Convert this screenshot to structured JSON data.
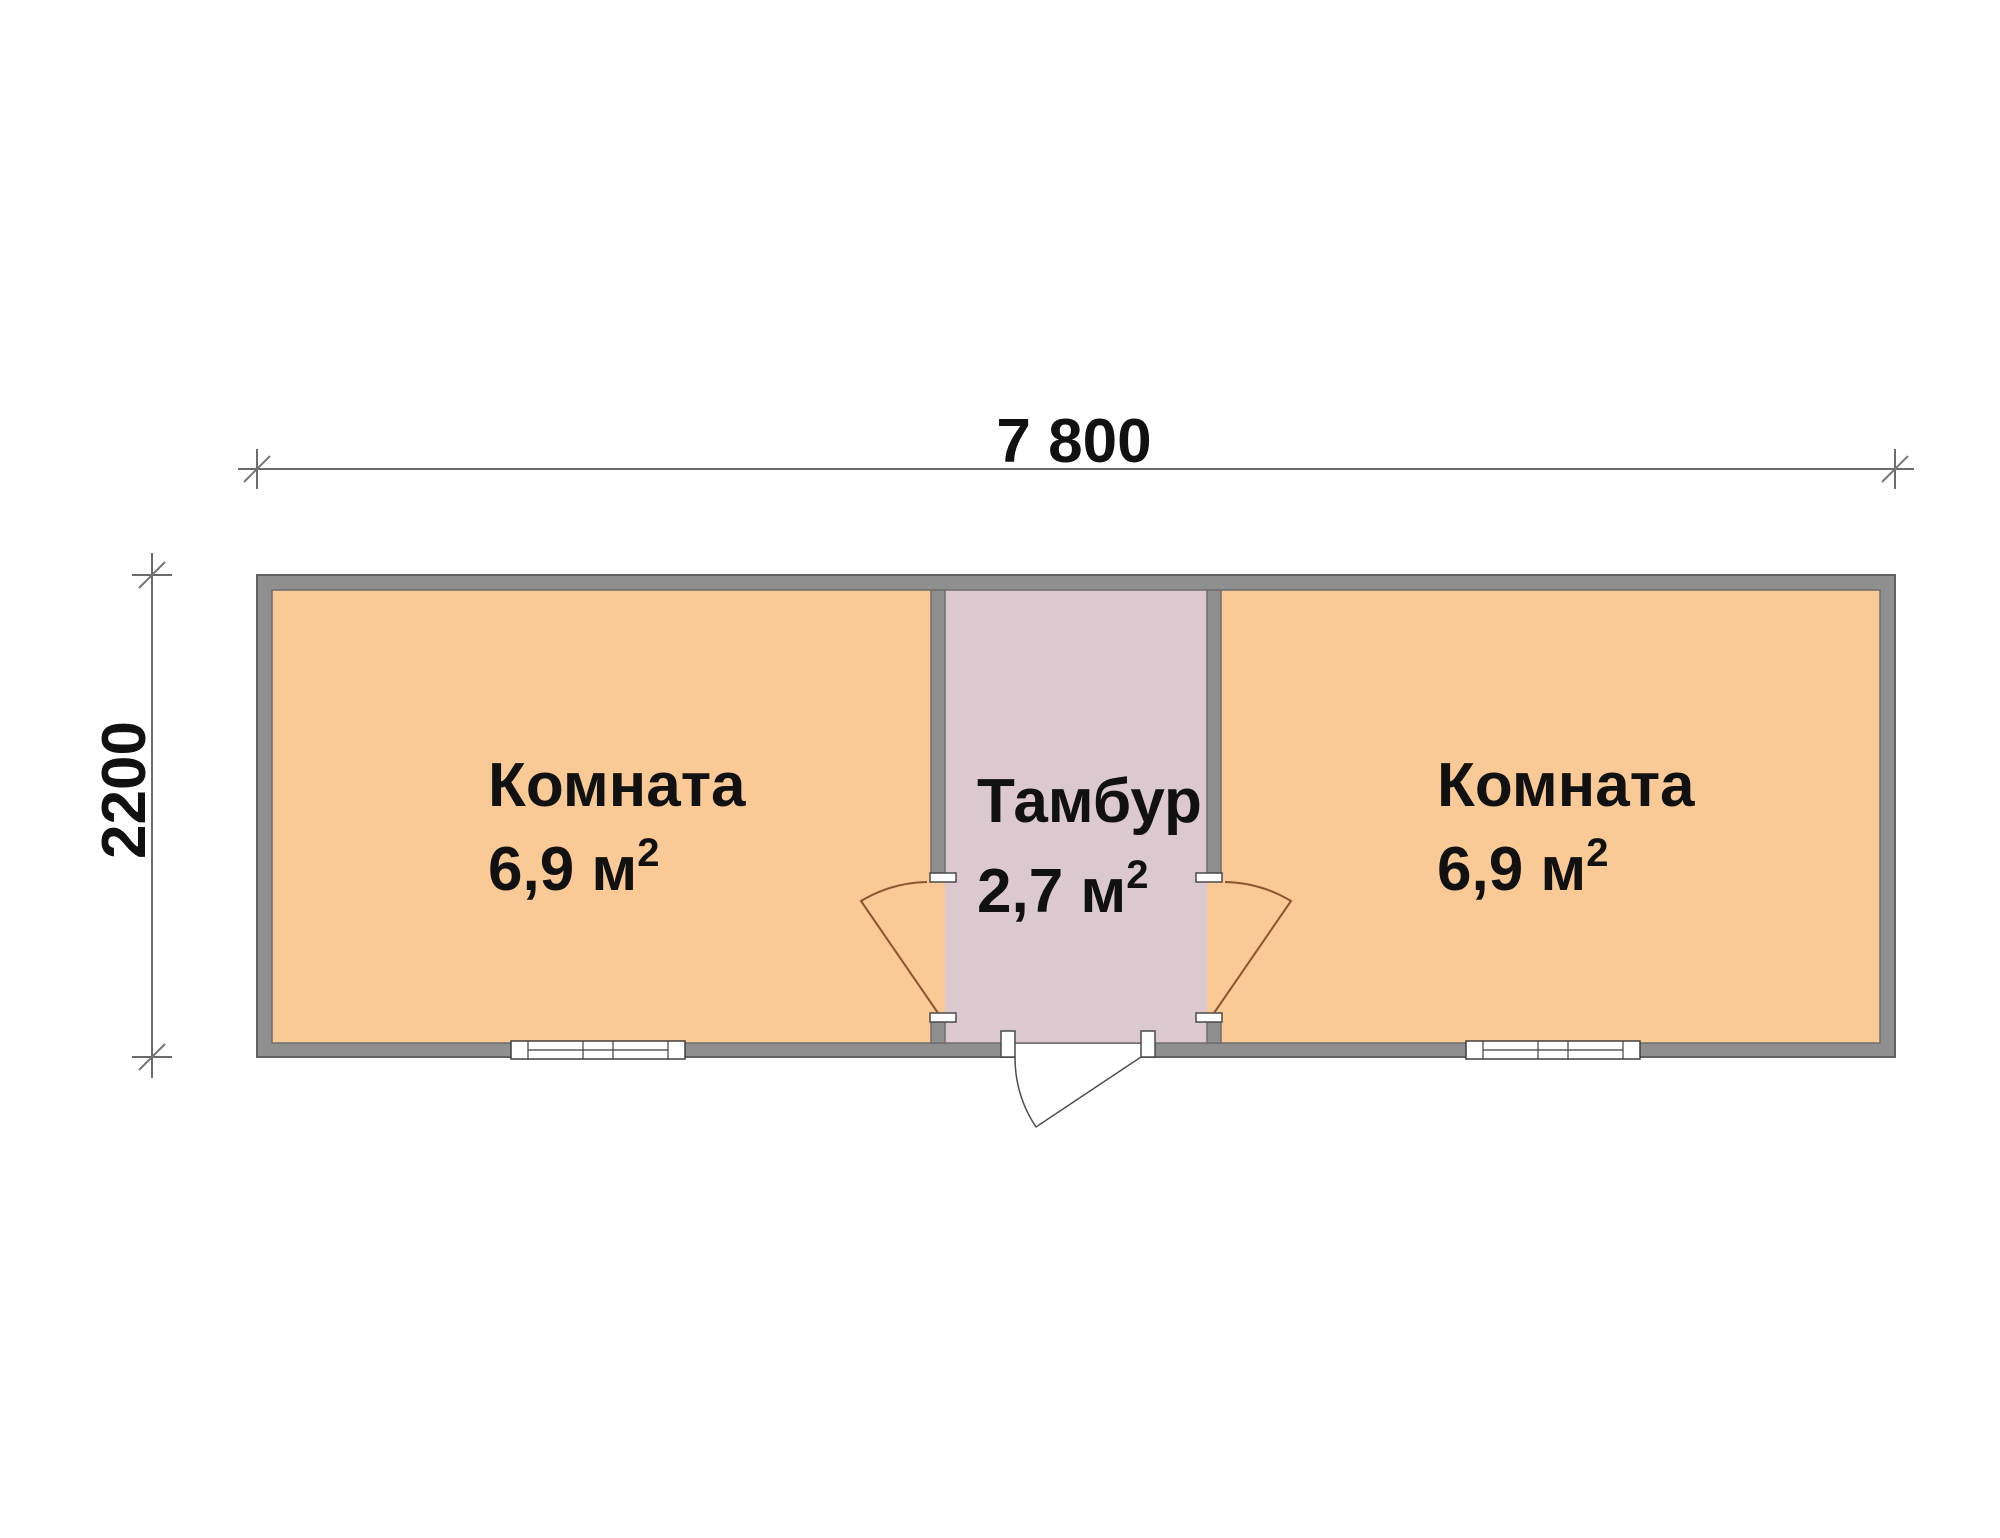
{
  "plan": {
    "dimensions": {
      "width_mm": "7 800",
      "height_mm": "2200"
    },
    "rooms": {
      "left": {
        "name": "Комната",
        "area": "6,9 м",
        "area_sup": "2"
      },
      "vestibule": {
        "name": "Тамбур",
        "area": "2,7 м",
        "area_sup": "2"
      },
      "right": {
        "name": "Комната",
        "area": "6,9 м",
        "area_sup": "2"
      }
    },
    "colors": {
      "room_fill": "#f9c996",
      "vestibule_fill": "#dcc9cf",
      "wall_fill": "#8f8f8f",
      "wall_outline": "#606060",
      "door_swing": "#8a5530",
      "exterior_door": "#4f4f4f",
      "dimension": "#3a3a3a",
      "text": "#111111"
    }
  }
}
